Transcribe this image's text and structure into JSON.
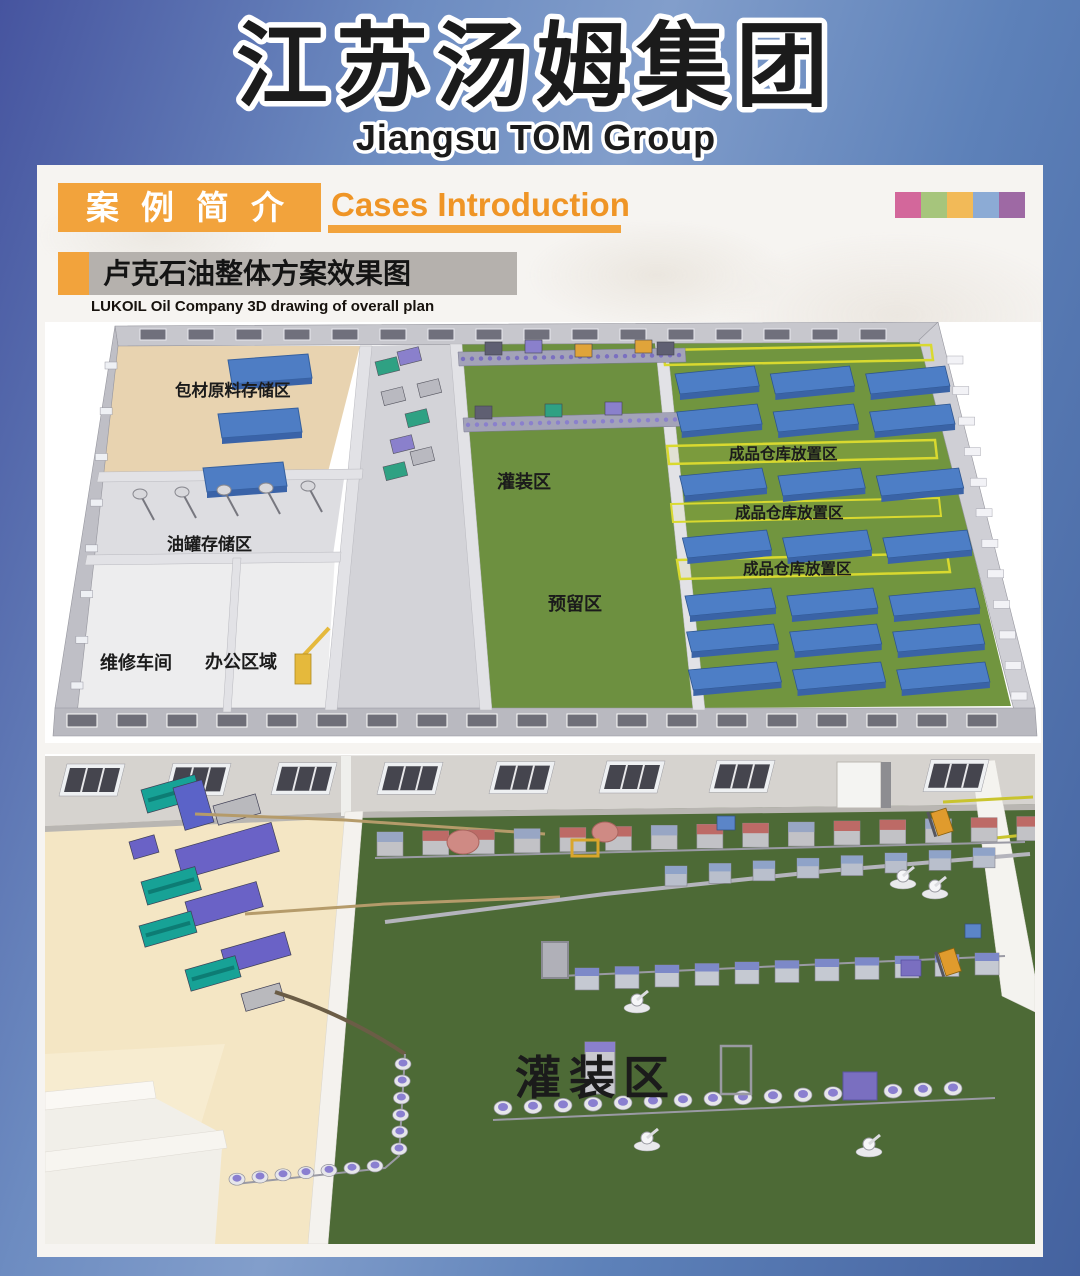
{
  "page": {
    "header": {
      "title_cn": "江苏汤姆集团",
      "title_en": "Jiangsu TOM Group",
      "title_color": "#e1251b"
    },
    "section": {
      "badge_cn": "案例简介",
      "title_en": "Cases Introduction",
      "accent_color": "#f2a33c"
    },
    "case": {
      "title_cn": "卢克石油整体方案效果图",
      "subtitle_en": "LUKOIL Oil Company 3D drawing of overall plan"
    },
    "palette": [
      "#d3679b",
      "#a6c57c",
      "#f2ba58",
      "#8cabd5",
      "#9e69a4"
    ]
  },
  "overview_render": {
    "labels": {
      "packaging_storage": "包材原料存储区",
      "oil_tank_storage": "油罐存储区",
      "maintenance_workshop": "维修车间",
      "office_area": "办公区域",
      "filling_area": "灌装区",
      "reserved_area": "预留区",
      "warehouse_rows": [
        "成品仓库放置区",
        "成品仓库放置区",
        "成品仓库放置区"
      ]
    },
    "colors": {
      "floor_green": "#6d9040",
      "pallet_blue": "#4d7ec6",
      "zone_line_yellow": "#d9d92f"
    }
  },
  "detail_render": {
    "filling_area": "灌装区",
    "colors": {
      "floor_green": "#4d6a36",
      "floor_tan": "#f4e6c4"
    }
  }
}
